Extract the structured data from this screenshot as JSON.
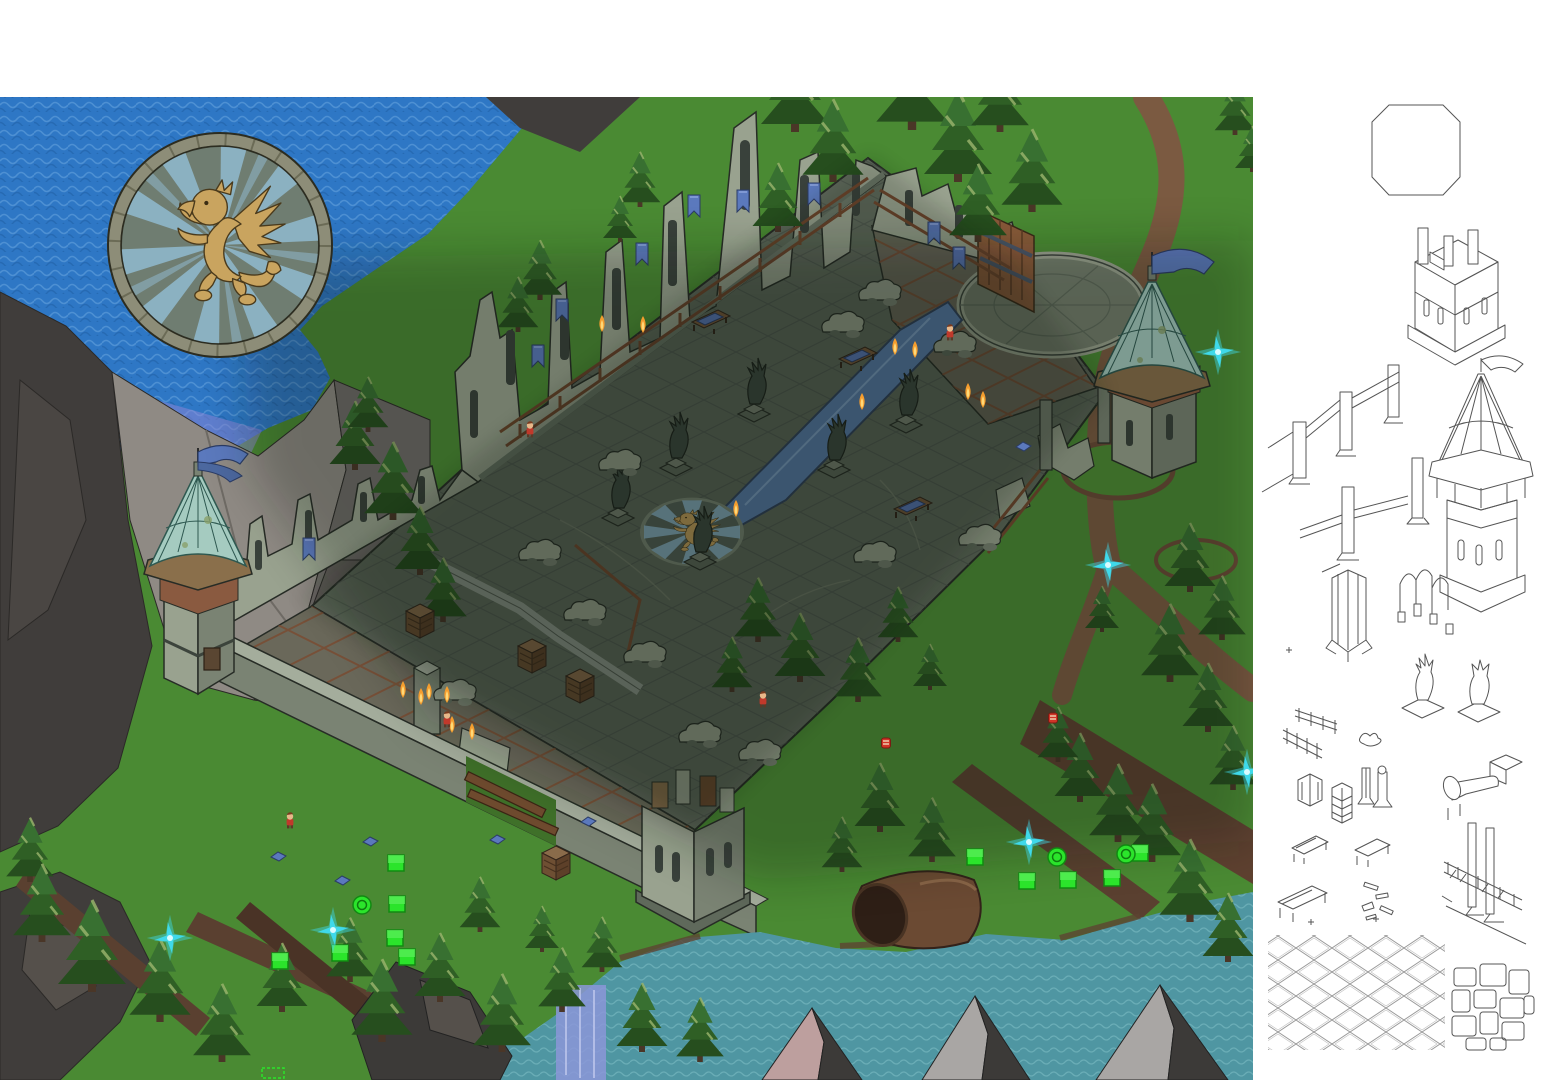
{
  "meta": {
    "width": 1556,
    "height": 1080,
    "description": "isometric ruined castle game map with asset sketch sidebar"
  },
  "palette": {
    "ocean": "#2e77c5",
    "ocean_wave": "#5b9bd9",
    "ocean_wave_dk": "#2261a6",
    "river": "#4f96a2",
    "river_wave": "#7fbec6",
    "grass": "#4a8a33",
    "grass_dk": "#3f7629",
    "cliff_dark": "#403d3b",
    "cliff_mid": "#6f6b68",
    "cliff_light": "#8f8a84",
    "cliff_facet": "#4a4643",
    "cliff_shadow": "#605c58",
    "stone_light": "#99a28f",
    "stone_mid": "#7a8373",
    "stone_dark": "#5f695b",
    "stone_top": "#a4ad9c",
    "outline": "#272c26",
    "floor": "#5f695b",
    "floor_line": "#49524a",
    "paving": "#6a685a",
    "rust": "#7a4a30",
    "roof": "#a5cbc0",
    "roof_line": "#2e5850",
    "trim": "#8a6f4b",
    "brick": "#8a5a40",
    "wood": "#6e4a2e",
    "wood_dk": "#3a2414",
    "gate": "#8a5a3a",
    "path": "#7b5a41",
    "path_dk": "#5e4130",
    "trail": "#5a4030",
    "pool": "#5b80b2",
    "pool_dk": "#31425e",
    "gold": "#c9a45f",
    "gold_dk": "#4a3a1c",
    "gold_bright": "#d9b26b",
    "ray": "#93bed6",
    "ring": "#8d8d78",
    "disc": "#6f7d71",
    "banner": "#5b79bd",
    "banner_dk": "#2b3c66",
    "flame": "#f59d2e",
    "flame_core": "#ffd978",
    "mgreen": "#2be42b",
    "mgreen_dk": "#128912",
    "sparkle": "#3fd9ea",
    "sparkle_core": "#d8fbff",
    "char_red": "#c0392b",
    "skin": "#e8b88a",
    "item_red": "#d03427",
    "tree1": "#264e1e",
    "tree2": "#2f5f25",
    "tree3": "#387031",
    "tree_tip": "#9cb56e",
    "trunk": "#4a3627",
    "rock_dark": "#3c3a38",
    "rock_mid": "#55504b",
    "rock_pink": "#bd9f9e",
    "rock_gray": "#a9a6a4",
    "falls": "#8b97d8",
    "shallow": "#8f86d8",
    "sketch_line": "#555555",
    "window": "#39413b",
    "white": "#ffffff"
  },
  "map": {
    "bounds": {
      "x": 0,
      "y": 97,
      "w": 1253,
      "h": 983
    },
    "medallion": {
      "cx": 220,
      "cy": 245,
      "r": 112,
      "motif": "golden griffin rampant on blue sun rays"
    },
    "floor_emblem": {
      "cx": 692,
      "cy": 532,
      "motif": "golden griffin on blue rays"
    },
    "towers": [
      {
        "name": "west-roofed-tower",
        "x": 197,
        "y": 600
      },
      {
        "name": "east-roofed-tower",
        "x": 1152,
        "y": 400
      },
      {
        "name": "south-ruined-tower",
        "x": 693,
        "y": 860
      }
    ],
    "trees": [
      [
        795,
        132,
        2.0
      ],
      [
        833,
        182,
        1.8
      ],
      [
        912,
        130,
        2.1
      ],
      [
        958,
        182,
        2.0
      ],
      [
        1000,
        132,
        1.7
      ],
      [
        1032,
        212,
        1.8
      ],
      [
        778,
        232,
        1.5
      ],
      [
        978,
        242,
        1.7
      ],
      [
        1235,
        135,
        1.2
      ],
      [
        1252,
        172,
        1.0
      ],
      [
        640,
        207,
        1.2
      ],
      [
        620,
        242,
        1.0
      ],
      [
        540,
        300,
        1.3
      ],
      [
        518,
        332,
        1.2
      ],
      [
        355,
        470,
        1.5
      ],
      [
        393,
        520,
        1.7
      ],
      [
        420,
        575,
        1.5
      ],
      [
        443,
        622,
        1.4
      ],
      [
        368,
        432,
        1.2
      ],
      [
        1190,
        592,
        1.5
      ],
      [
        1222,
        640,
        1.4
      ],
      [
        1170,
        682,
        1.7
      ],
      [
        1208,
        732,
        1.5
      ],
      [
        1233,
        790,
        1.4
      ],
      [
        1152,
        862,
        1.7
      ],
      [
        1190,
        922,
        1.8
      ],
      [
        1228,
        962,
        1.5
      ],
      [
        1102,
        632,
        1.0
      ],
      [
        758,
        642,
        1.4
      ],
      [
        800,
        682,
        1.5
      ],
      [
        732,
        692,
        1.2
      ],
      [
        858,
        702,
        1.4
      ],
      [
        898,
        642,
        1.2
      ],
      [
        930,
        690,
        1.0
      ],
      [
        880,
        832,
        1.5
      ],
      [
        932,
        862,
        1.4
      ],
      [
        842,
        872,
        1.2
      ],
      [
        1080,
        802,
        1.5
      ],
      [
        1118,
        842,
        1.7
      ],
      [
        1058,
        762,
        1.2
      ],
      [
        30,
        882,
        1.4
      ],
      [
        42,
        942,
        1.7
      ],
      [
        92,
        992,
        2.0
      ],
      [
        160,
        1022,
        1.8
      ],
      [
        222,
        1062,
        1.7
      ],
      [
        282,
        1012,
        1.5
      ],
      [
        350,
        982,
        1.4
      ],
      [
        382,
        1042,
        1.8
      ],
      [
        440,
        1002,
        1.5
      ],
      [
        502,
        1052,
        1.7
      ],
      [
        562,
        1012,
        1.4
      ],
      [
        642,
        1052,
        1.5
      ],
      [
        480,
        932,
        1.2
      ],
      [
        542,
        952,
        1.0
      ],
      [
        602,
        972,
        1.2
      ],
      [
        700,
        1062,
        1.4
      ]
    ],
    "statues": [
      [
        676,
        468
      ],
      [
        754,
        414
      ],
      [
        834,
        470
      ],
      [
        906,
        425
      ],
      [
        700,
        562
      ],
      [
        618,
        518
      ]
    ],
    "benches": [
      [
        710,
        330
      ],
      [
        857,
        367
      ],
      [
        912,
        517
      ]
    ],
    "shelves": [
      [
        420,
        630
      ],
      [
        532,
        665
      ],
      [
        580,
        695
      ],
      [
        556,
        872
      ]
    ],
    "rubble": [
      [
        620,
        470
      ],
      [
        843,
        332
      ],
      [
        955,
        352
      ],
      [
        585,
        620
      ],
      [
        700,
        742
      ],
      [
        875,
        562
      ],
      [
        645,
        662
      ],
      [
        455,
        700
      ],
      [
        980,
        545
      ],
      [
        540,
        560
      ],
      [
        760,
        760
      ],
      [
        880,
        300
      ]
    ],
    "banners": [
      [
        688,
        195
      ],
      [
        737,
        190
      ],
      [
        808,
        183
      ],
      [
        636,
        243
      ],
      [
        556,
        299
      ],
      [
        532,
        345
      ],
      [
        928,
        222
      ],
      [
        953,
        247
      ],
      [
        303,
        538
      ]
    ],
    "markers": {
      "green_squares": [
        [
          396,
          863
        ],
        [
          397,
          904
        ],
        [
          395,
          938
        ],
        [
          407,
          957
        ],
        [
          340,
          953
        ],
        [
          280,
          961
        ],
        [
          975,
          857
        ],
        [
          1027,
          881
        ],
        [
          1068,
          880
        ],
        [
          1112,
          878
        ],
        [
          1140,
          853
        ]
      ],
      "green_circles": [
        [
          362,
          905
        ],
        [
          1057,
          857
        ],
        [
          1126,
          854
        ]
      ],
      "cyan_sparkles": [
        [
          1218,
          352
        ],
        [
          1108,
          565
        ],
        [
          1247,
          772
        ],
        [
          1029,
          842
        ],
        [
          333,
          930
        ],
        [
          170,
          938
        ]
      ],
      "red_items": [
        [
          886,
          748
        ],
        [
          1053,
          723
        ]
      ],
      "characters": [
        [
          950,
          340
        ],
        [
          447,
          727
        ],
        [
          290,
          828
        ],
        [
          530,
          437
        ],
        [
          763,
          707
        ]
      ],
      "torch_flames": [
        [
          602,
          332
        ],
        [
          643,
          333
        ],
        [
          895,
          355
        ],
        [
          915,
          358
        ],
        [
          862,
          410
        ],
        [
          429,
          700
        ],
        [
          447,
          703
        ],
        [
          452,
          733
        ],
        [
          472,
          740
        ],
        [
          968,
          400
        ],
        [
          983,
          408
        ],
        [
          736,
          517
        ],
        [
          421,
          705
        ],
        [
          403,
          698
        ]
      ],
      "blue_debris": [
        [
          278,
          857
        ],
        [
          342,
          881
        ],
        [
          370,
          842
        ],
        [
          588,
          822
        ],
        [
          497,
          840
        ],
        [
          1023,
          447
        ]
      ]
    }
  },
  "sidebar": {
    "background": "#ffffff",
    "sketches": [
      {
        "name": "octagon-outline"
      },
      {
        "name": "ruined-square-tower-sketch"
      },
      {
        "name": "wall-fence-sketch"
      },
      {
        "name": "wall-post-sketch"
      },
      {
        "name": "pillar-sketch"
      },
      {
        "name": "roofed-tower-sketch"
      },
      {
        "name": "obelisk-column-sketch"
      },
      {
        "name": "gothic-arches-sketch"
      },
      {
        "name": "railing-sketches"
      },
      {
        "name": "griffin-statue-sketches"
      },
      {
        "name": "plant-sketch"
      },
      {
        "name": "cabinet-sketch"
      },
      {
        "name": "shelf-sketch"
      },
      {
        "name": "column-sketches"
      },
      {
        "name": "fallen-statue-sketch"
      },
      {
        "name": "bench-sketches"
      },
      {
        "name": "table-sketch"
      },
      {
        "name": "debris-sketch"
      },
      {
        "name": "bridge-sketch"
      },
      {
        "name": "lattice-tile-swatch"
      },
      {
        "name": "flagstone-tile-swatch"
      }
    ]
  }
}
